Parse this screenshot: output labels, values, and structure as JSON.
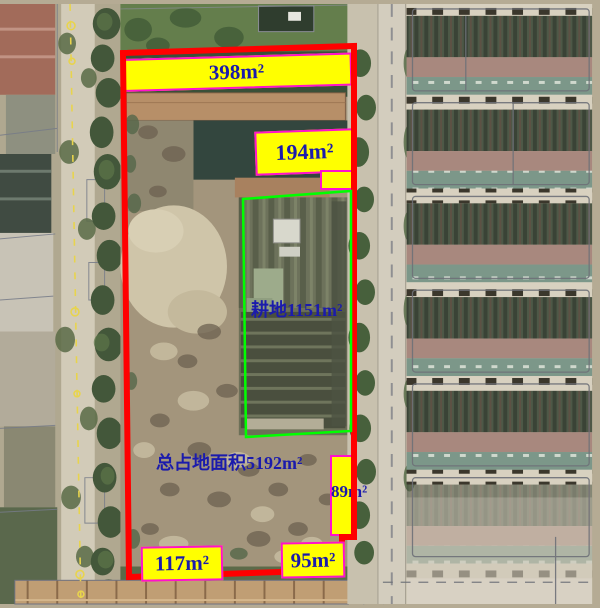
{
  "map": {
    "type": "aerial-parcel-annotation",
    "labels": {
      "top_area": "398m²",
      "upper_area": "194m²",
      "plot_area": "耕地1151m²",
      "total_area": "总占地面积5192m²",
      "right_area": "89m²",
      "bottom_left_area": "117m²",
      "bottom_right_area": "95m²"
    },
    "colors": {
      "boundary": "#ff0000",
      "plot_outline": "#00ff00",
      "label_background": "#ffff00",
      "label_border": "#ff12cc",
      "label_text": "#1b1bac",
      "cadastral_line": "#767b88",
      "marker_line": "#e8d44c"
    }
  }
}
